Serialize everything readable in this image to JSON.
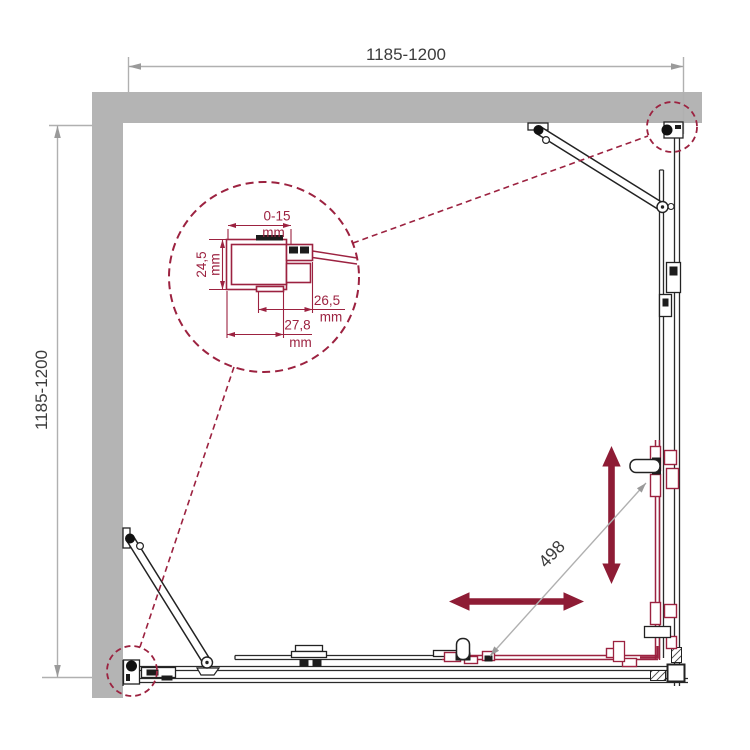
{
  "drawing": {
    "title": "corner shower enclosure plan view",
    "width_label": "1185-1200",
    "depth_label": "1185-1200",
    "diagonal_label": "498",
    "detail": {
      "adjustment": {
        "value": "0-15",
        "unit": "mm"
      },
      "profile_width": {
        "value": "24,5",
        "unit": "mm"
      },
      "inner_depth": {
        "value": "26,5",
        "unit": "mm"
      },
      "outer_depth": {
        "value": "27,8",
        "unit": "mm"
      }
    },
    "colors": {
      "wall": "#b4b4b4",
      "frame": "#2a2a2a",
      "accent": "#9c2240",
      "arrow": "#8e1c35",
      "dim_line": "#b0b0b0",
      "text": "#3c3c3c"
    }
  }
}
